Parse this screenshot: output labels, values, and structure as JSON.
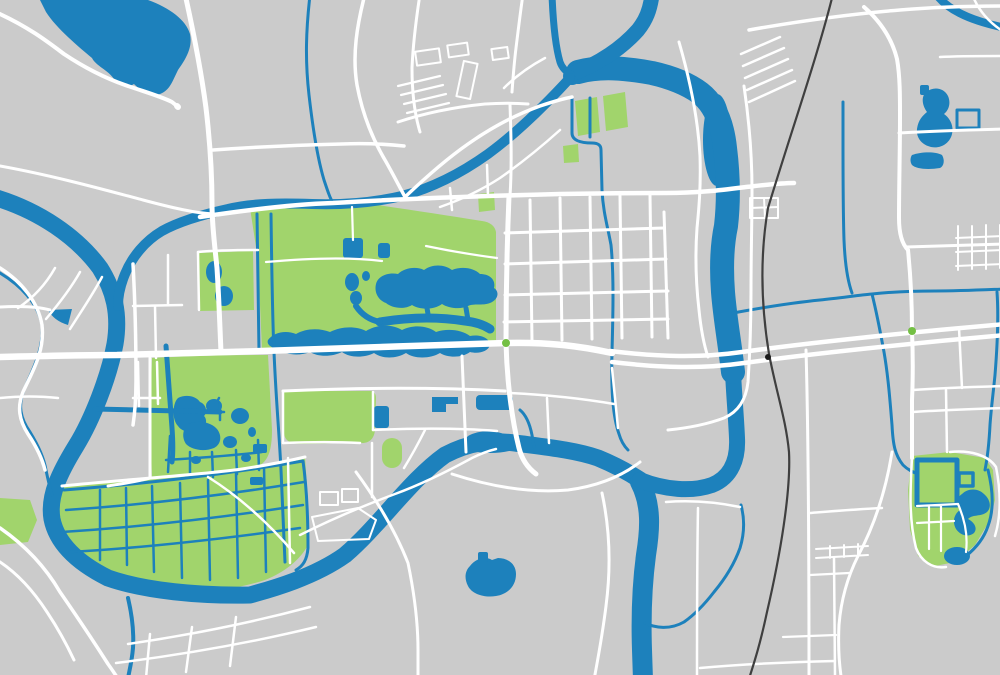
{
  "map": {
    "type": "city-street-map-illustration",
    "canvas": {
      "width": 1000,
      "height": 675
    },
    "colors": {
      "land": "#cbcbcb",
      "road": "#ffffff",
      "water": "#1d81bc",
      "park": "#a1d46c",
      "railway": "#3f3f3f",
      "poi_dot": "#74c044",
      "crossing_dot": "#1c1c1c"
    },
    "layers": [
      {
        "id": "land",
        "label": "land background"
      },
      {
        "id": "parks",
        "label": "parks and green areas"
      },
      {
        "id": "water",
        "label": "rivers, lakes, canals"
      },
      {
        "id": "roads",
        "label": "street network"
      },
      {
        "id": "railway",
        "label": "railway line"
      },
      {
        "id": "markers",
        "label": "point markers"
      }
    ],
    "features": {
      "water": [
        "northwest-lake",
        "west-river",
        "southwest-river-loop",
        "diagonal-river",
        "north-river-narrow",
        "northeast-river-arm",
        "east-vertical-river",
        "south-river-branch",
        "top-right-stream",
        "east-wavy-stream",
        "central-lake-chain",
        "southwest-pond-cluster",
        "wetland-canal-grid",
        "northeast-pond-group",
        "walled-park-moat",
        "isolated-south-lake",
        "left-ring-canal",
        "small-wedge-pond"
      ],
      "parks": [
        "central-park",
        "west-pond-park",
        "southwest-park",
        "wetland-park",
        "riverbank-green-west",
        "mid-south-park",
        "green-capsule",
        "twin-green-blocks-north",
        "southeast-walled-park",
        "small-north-greens"
      ],
      "markers": [
        {
          "name": "poi-dot",
          "x": 506,
          "y": 343
        },
        {
          "name": "poi-dot",
          "x": 912,
          "y": 331
        },
        {
          "name": "railway-crossing-dot",
          "x": 768,
          "y": 357
        },
        {
          "name": "road-end-dot",
          "x": 178,
          "y": 107
        }
      ]
    }
  }
}
